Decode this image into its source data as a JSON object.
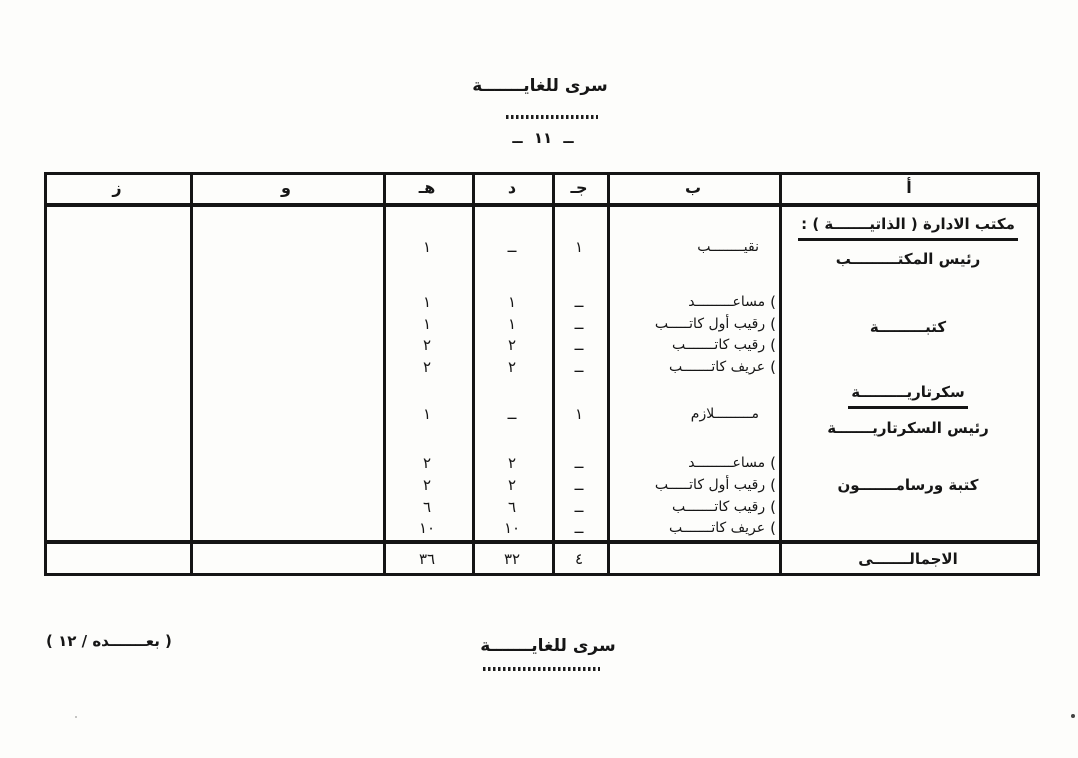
{
  "page": {
    "classification": "سرى للغايـــــــة",
    "page_number": "ــ ١١ ــ",
    "classification_bottom": "سرى للغايـــــــة",
    "continuation_note": "( بعـــــــده / ١٢ )"
  },
  "table": {
    "brace_glyph": "(",
    "headers": {
      "a": "أ",
      "b": "ب",
      "j": "جـ",
      "d": "د",
      "h": "هـ",
      "w": "و",
      "z": "ز"
    },
    "sections": [
      {
        "title": "مكتب الادارة ( الذاتيـــــــة ) :",
        "subtitle": "رئيس المكتـــــــــب",
        "rows": [
          {
            "rank": "نقيــــــــب",
            "j": "١",
            "d": "ــ",
            "h": "١"
          }
        ]
      },
      {
        "title": "كتبـــــــــة",
        "rows": [
          {
            "rank": "مساعـــــــــد",
            "j": "ــ",
            "d": "١",
            "h": "١"
          },
          {
            "rank": "رقيب أول كاتـــــب",
            "j": "ــ",
            "d": "١",
            "h": "١"
          },
          {
            "rank": "رقيب كاتـــــــب",
            "j": "ــ",
            "d": "٢",
            "h": "٢"
          },
          {
            "rank": "عريف كاتـــــــب",
            "j": "ــ",
            "d": "٢",
            "h": "٢"
          }
        ]
      },
      {
        "title": "سكرتاريـــــــــة",
        "subtitle": "رئيس السكرتاريـــــــة",
        "rows": [
          {
            "rank": "مـــــــــلازم",
            "j": "١",
            "d": "ــ",
            "h": "١"
          }
        ]
      },
      {
        "title": "كتبة ورسامـــــــون",
        "rows": [
          {
            "rank": "مساعـــــــــد",
            "j": "ــ",
            "d": "٢",
            "h": "٢"
          },
          {
            "rank": "رقيب أول كاتـــــب",
            "j": "ــ",
            "d": "٢",
            "h": "٢"
          },
          {
            "rank": "رقيب كاتـــــــب",
            "j": "ــ",
            "d": "٦",
            "h": "٦"
          },
          {
            "rank": "عريف كاتـــــــب",
            "j": "ــ",
            "d": "١٠",
            "h": "١٠"
          }
        ]
      }
    ],
    "totals": {
      "label": "الاجمالـــــــى",
      "j": "٤",
      "d": "٣٢",
      "h": "٣٦"
    }
  }
}
